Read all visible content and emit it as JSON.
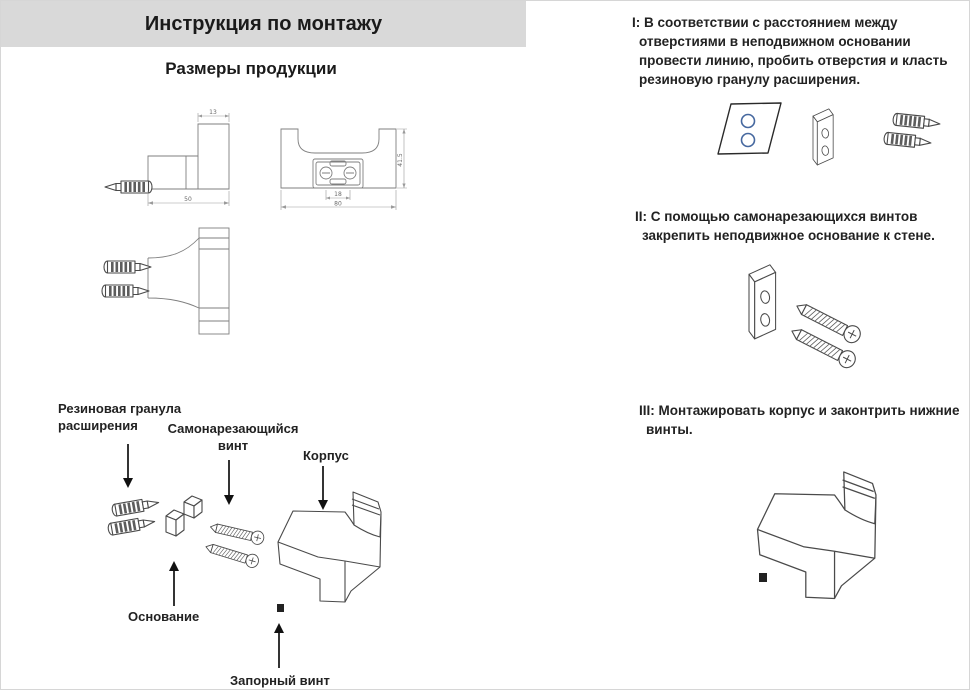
{
  "header": {
    "title": "Инструкция по монтажу"
  },
  "left": {
    "subtitle": "Размеры продукции",
    "dimensions": {
      "top_width": "13",
      "bottom_width": "50",
      "height": "41.5",
      "hole_spacing": "18",
      "overall_width": "80"
    },
    "labels": {
      "anchor": "Резиновая гранула расширения",
      "screw": "Самонарезающийся винт",
      "body": "Корпус",
      "base": "Основание",
      "lock_screw": "Запорный винт"
    }
  },
  "steps": [
    {
      "text": "I: В соответствии с расстоянием между отверстиями в неподвижном основании провести линию, пробить отверстия и класть резиновую гранулу расширения."
    },
    {
      "text": "II: С помощью самонарезающихся винтов закрепить неподвижное основание к стене."
    },
    {
      "text": "III: Монтажировать корпус и законтрить нижние винты."
    }
  ],
  "colors": {
    "header_bg": "#d9d9d9",
    "hole_blue": "#46689f",
    "line_dark": "#4a4a4a",
    "line_tech": "#7f7f7f"
  }
}
